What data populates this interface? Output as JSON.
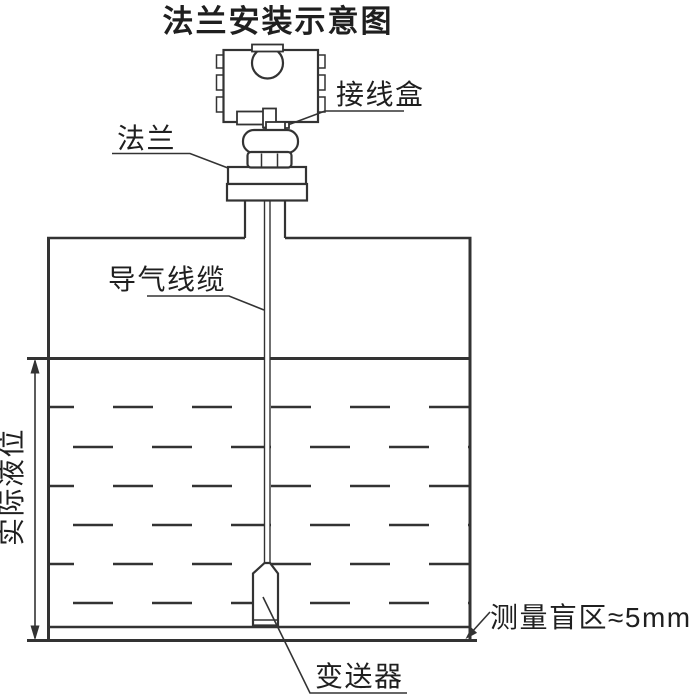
{
  "diagram": {
    "title": "法兰安装示意图",
    "labels": {
      "junction_box": "接线盒",
      "flange": "法兰",
      "air_cable": "导气线缆",
      "actual_level": "实际液位",
      "transmitter": "变送器",
      "blind_zone": "测量盲区≈5mm"
    },
    "colors": {
      "line": "#333333",
      "text": "#1f1f1f",
      "background": "#ffffff"
    }
  }
}
